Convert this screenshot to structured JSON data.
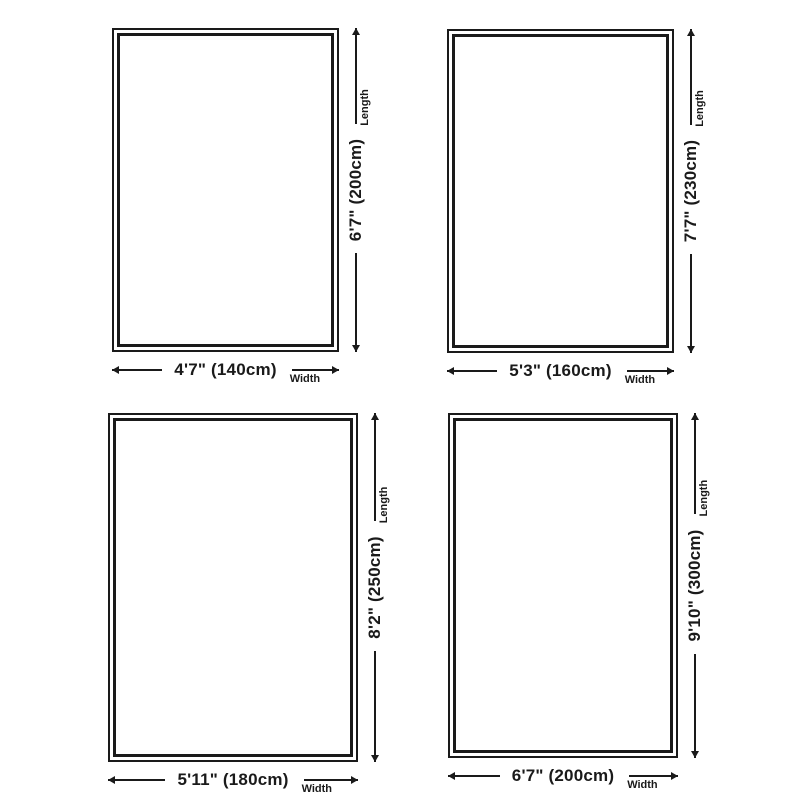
{
  "colors": {
    "ink": "#1a1a1a",
    "bg": "#ffffff"
  },
  "captions": {
    "width": "Width",
    "length": "Length"
  },
  "panels": [
    {
      "id": "rug-140x200",
      "width_label": "4'7\" (140cm)",
      "length_label": "6'7\" (200cm)"
    },
    {
      "id": "rug-160x230",
      "width_label": "5'3\" (160cm)",
      "length_label": "7'7\" (230cm)"
    },
    {
      "id": "rug-180x250",
      "width_label": "5'11\" (180cm)",
      "length_label": "8'2\" (250cm)"
    },
    {
      "id": "rug-200x300",
      "width_label": "6'7\" (200cm)",
      "length_label": "9'10\" (300cm)"
    }
  ]
}
